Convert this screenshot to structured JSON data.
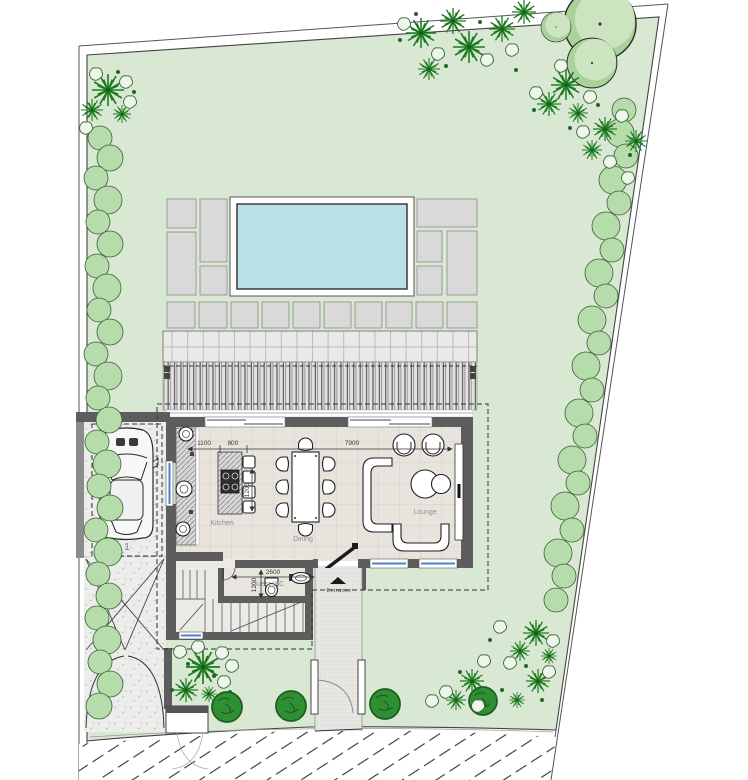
{
  "page": {
    "type": "architectural-site-plan",
    "background": "#ffffff"
  },
  "rooms": {
    "kitchen": "Kitchen",
    "dining": "Dining",
    "lounge": "Lounge",
    "guest_wc": "Guest WC"
  },
  "labels": {
    "entrance": "Entrance",
    "parking_space_number": "1"
  },
  "dimensions": {
    "kitchen_wall": "1100",
    "kitchen_island": "800",
    "open_plan_width": "7900",
    "wc_width": "2600",
    "wc_depth": "1200",
    "island_length": "1200"
  },
  "colors": {
    "lawn": "#d9e8d2",
    "hedge": "#b7dcab",
    "palm": "#1e7b22",
    "bush_dark": "#2f8f35",
    "tree_canopy": "#cde4c0",
    "tree_shade": "#a9d39b",
    "pool_water": "#b9e0e8",
    "paving_tile": "#dbdbdb",
    "wall_gray": "#5d5d5d",
    "floor": "#e8e4dd",
    "window_blue": "#4d7fd0",
    "outdoor_paving": "#ecedea"
  }
}
